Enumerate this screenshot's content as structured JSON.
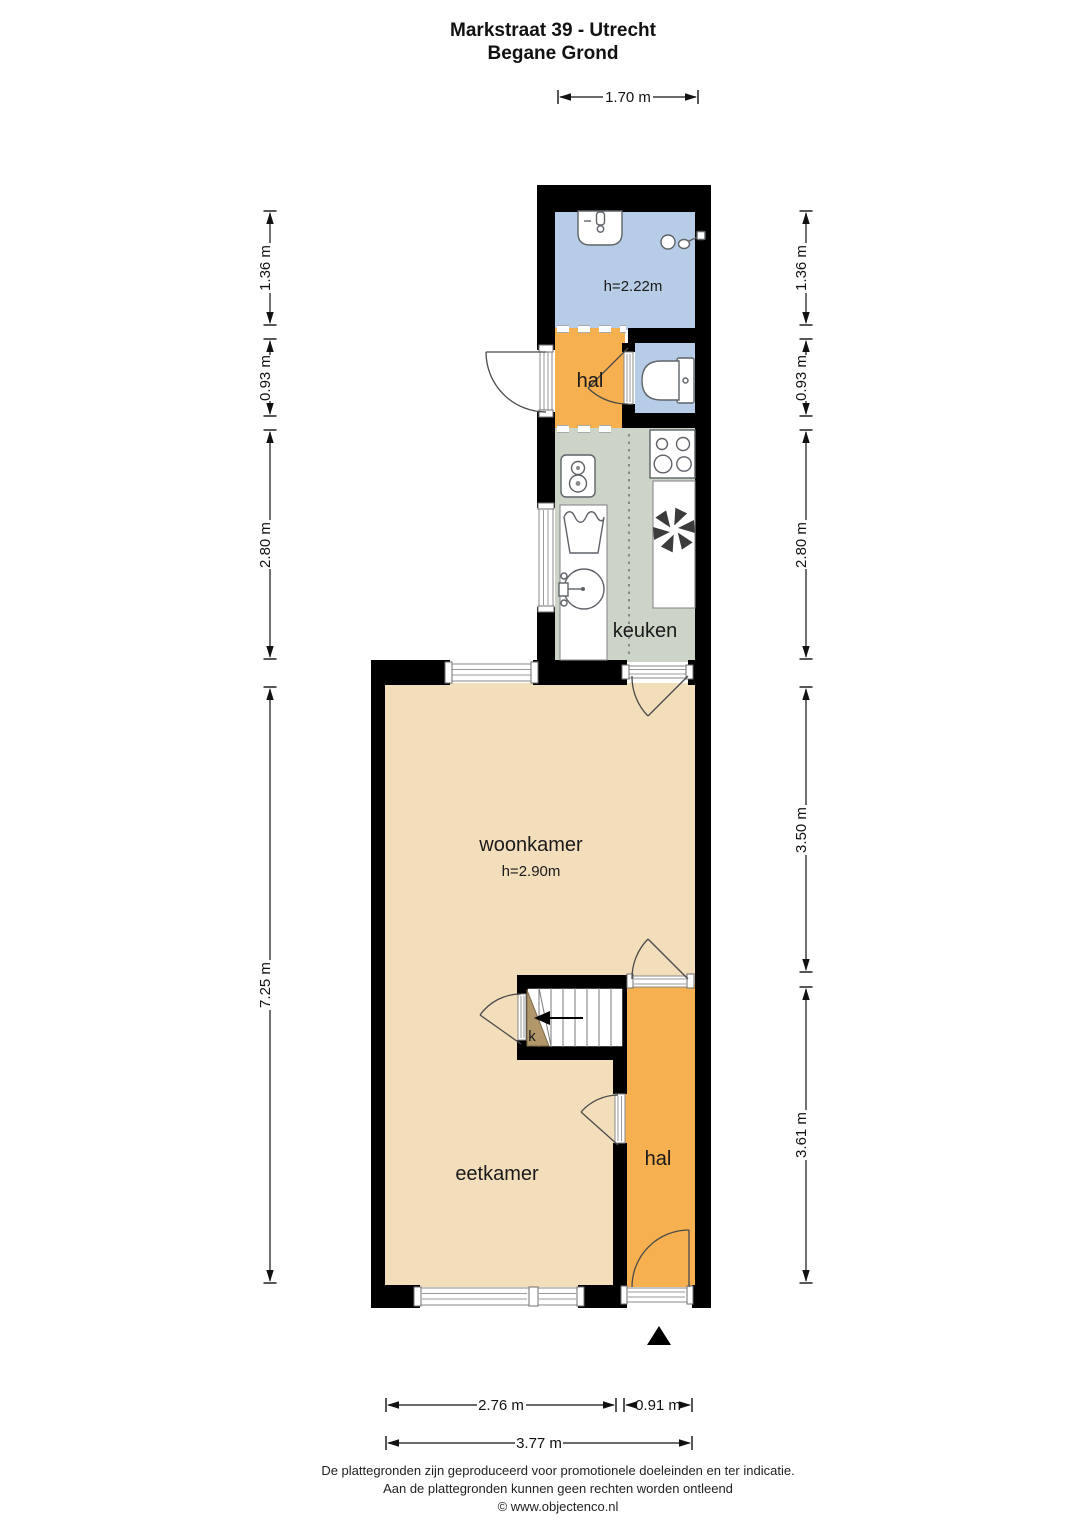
{
  "title": {
    "line1": "Markstraat 39 - Utrecht",
    "line2": "Begane Grond"
  },
  "rooms": {
    "badkamer": {
      "height_label": "h=2.22m"
    },
    "hal_boven": {
      "label": "hal"
    },
    "keuken": {
      "label": "keuken"
    },
    "woonkamer": {
      "label": "woonkamer",
      "height_label": "h=2.90m"
    },
    "eetkamer": {
      "label": "eetkamer"
    },
    "hal": {
      "label": "hal"
    },
    "trapkast": {
      "label": "k"
    }
  },
  "dimensions": {
    "top": {
      "width": "1.70 m"
    },
    "left": {
      "badkamer": "1.36 m",
      "hal": "0.93 m",
      "keuken": "2.80 m",
      "woon_eetkamer": "7.25 m"
    },
    "right": {
      "badkamer": "1.36 m",
      "hal": "0.93 m",
      "keuken": "2.80 m",
      "woonkamer": "3.50 m",
      "hal_eetkamer": "3.61 m"
    },
    "bottom": {
      "eetkamer": "2.76 m",
      "hal": "0.91 m",
      "totaal": "3.77 m"
    }
  },
  "fixtures": [
    "washbasin",
    "shower",
    "toilet",
    "boiler",
    "laundry-tub",
    "round-sink",
    "stove",
    "extractor-fan",
    "stairs",
    "entrance-marker"
  ],
  "footer": {
    "line1": "De plattegronden zijn geproduceerd voor promotionele doeleinden en ter indicatie.",
    "line2": "Aan de plattegronden kunnen geen rechten worden ontleend",
    "line3": "© www.objectenco.nl"
  },
  "colors": {
    "wall": "#000000",
    "bad_toilet": "#b7cce6",
    "hal": "#f6b04f",
    "keuken": "#ccd3c7",
    "woon_eetkamer": "#f3debb",
    "kast": "#b2976b"
  }
}
